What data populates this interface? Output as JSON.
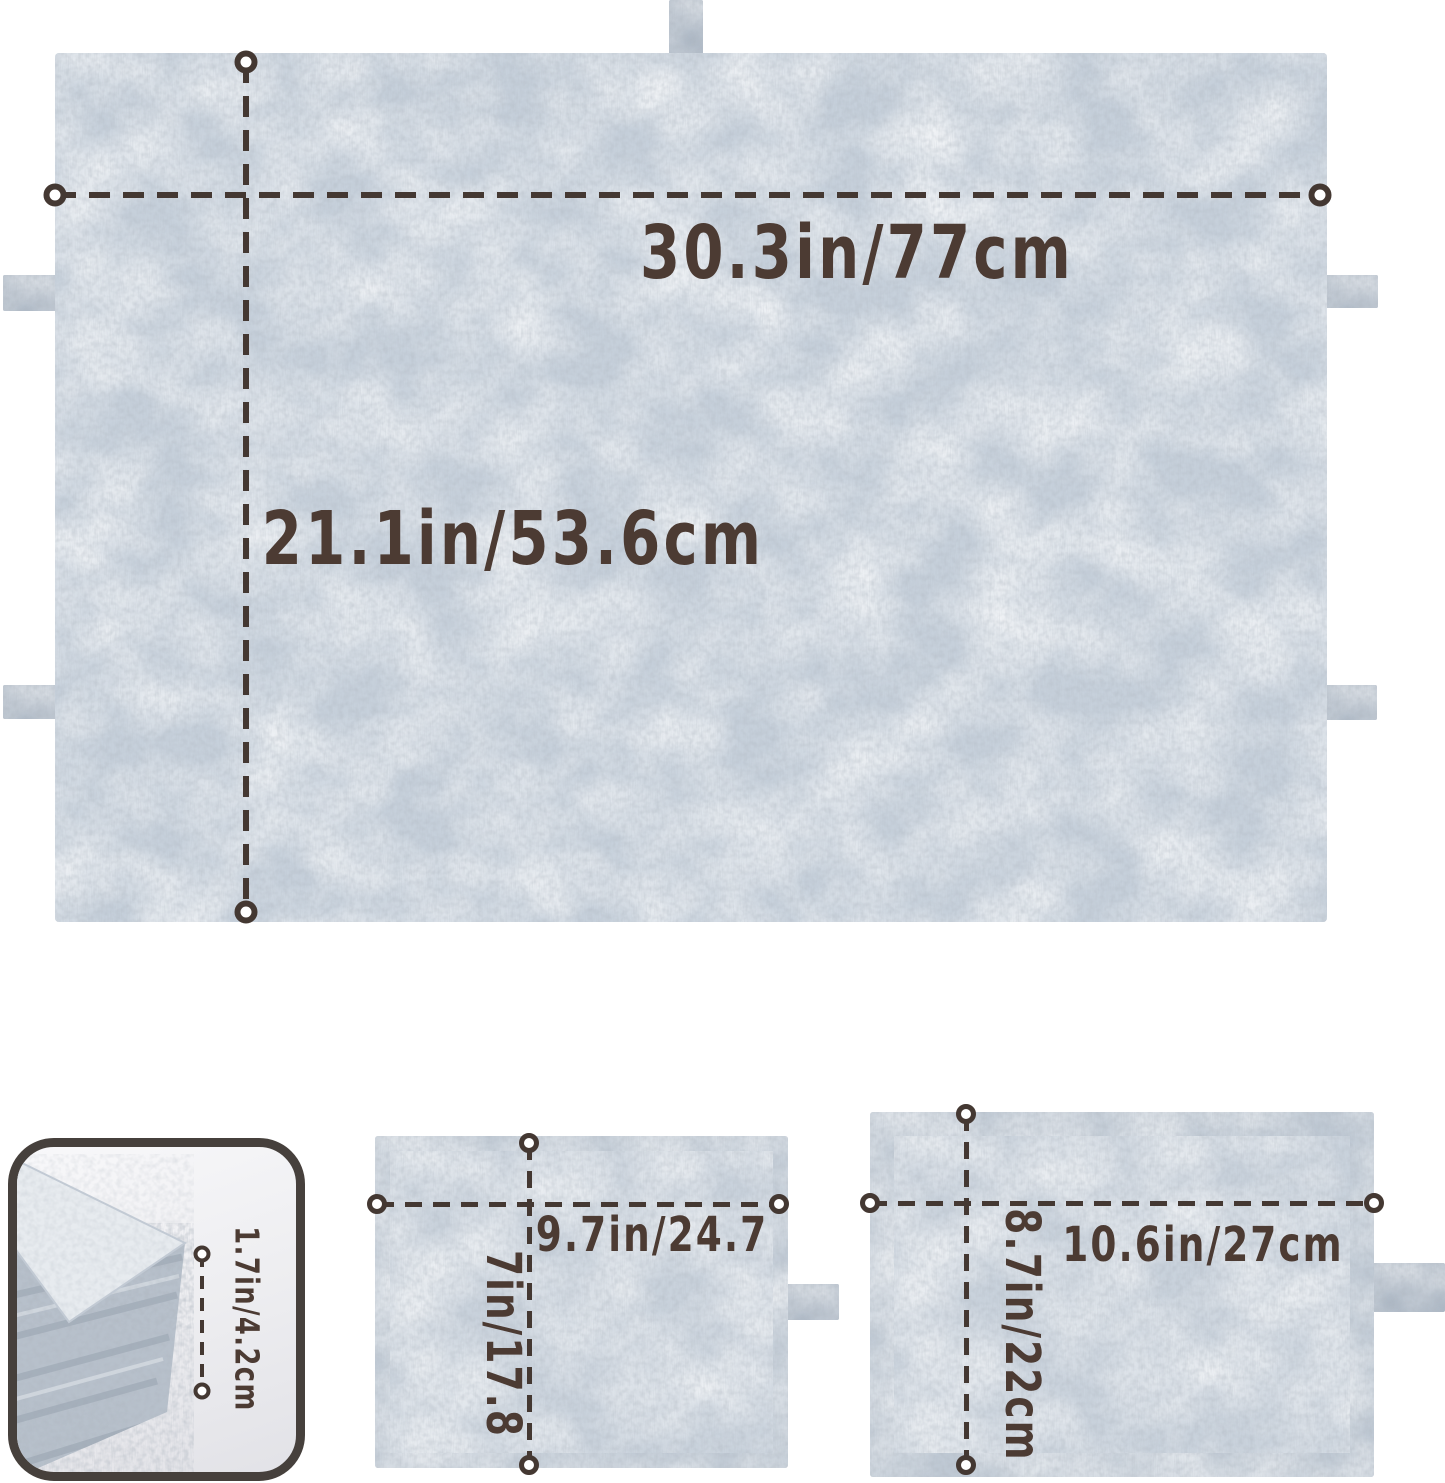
{
  "style": {
    "background": "#ffffff",
    "annotation_text_color": "#4c3b33",
    "dimension_line_color": "#443832",
    "felt_base_color": "#c6d0db",
    "felt_tab_color": "#a6b2c0",
    "detail_box_border_color": "#46403c"
  },
  "main_mat": {
    "width_label": "30.3in/77cm",
    "height_label": "21.1in/53.6cm"
  },
  "thickness_detail": {
    "label": "1.7in/4.2cm"
  },
  "small_tray": {
    "width_label": "9.7in/24.7",
    "height_label": "7in/17.8"
  },
  "large_tray": {
    "width_label": "10.6in/27cm",
    "height_label": "8.7in/22cm"
  }
}
